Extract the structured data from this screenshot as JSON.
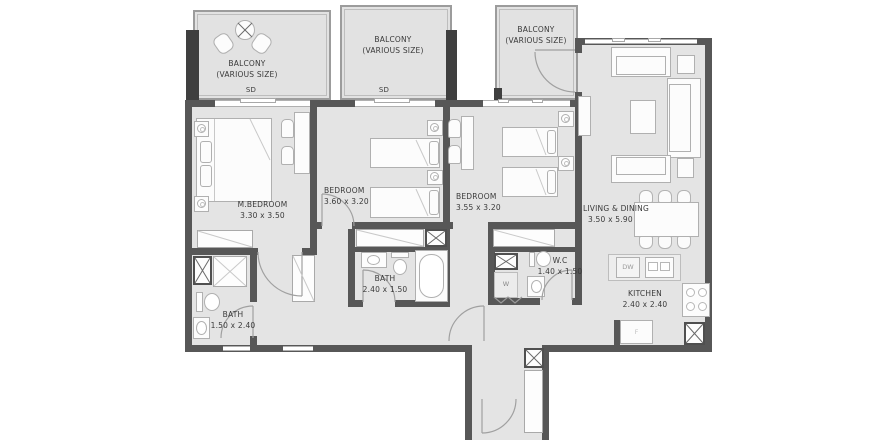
{
  "plan": {
    "balconies": [
      {
        "name": "BALCONY",
        "size_note": "(VARIOUS SIZE)",
        "door": "SD"
      },
      {
        "name": "BALCONY",
        "size_note": "(VARIOUS SIZE)",
        "door": "SD"
      },
      {
        "name": "BALCONY",
        "size_note": "(VARIOUS SIZE)"
      }
    ],
    "rooms": [
      {
        "id": "master-bedroom",
        "label": "M.BEDROOM",
        "dims": "3.30 x 3.50"
      },
      {
        "id": "bedroom-2",
        "label": "BEDROOM",
        "dims": "3.60 x 3.20"
      },
      {
        "id": "bedroom-3",
        "label": "BEDROOM",
        "dims": "3.55 x 3.20"
      },
      {
        "id": "living-dining",
        "label": "LIVING & DINING",
        "dims": "3.50 x 5.90"
      },
      {
        "id": "kitchen",
        "label": "KITCHEN",
        "dims": "2.40 x 2.40"
      },
      {
        "id": "master-bath",
        "label": "BATH",
        "dims": "1.50 x 2.40"
      },
      {
        "id": "shared-bath",
        "label": "BATH",
        "dims": "2.40 x 1.50"
      },
      {
        "id": "wc",
        "label": "W.C",
        "dims": "1.40 x 1.50"
      }
    ],
    "appliances": {
      "dishwasher": "DW",
      "washer": "W",
      "fridge": "F"
    },
    "colors": {
      "wall": "#575757",
      "pillar": "#3f3f3f",
      "floor": "#e4e4e4",
      "balcony_floor": "#e2e2e2",
      "furniture_line": "#b0b0b0",
      "text": "#3a3a3a"
    }
  }
}
